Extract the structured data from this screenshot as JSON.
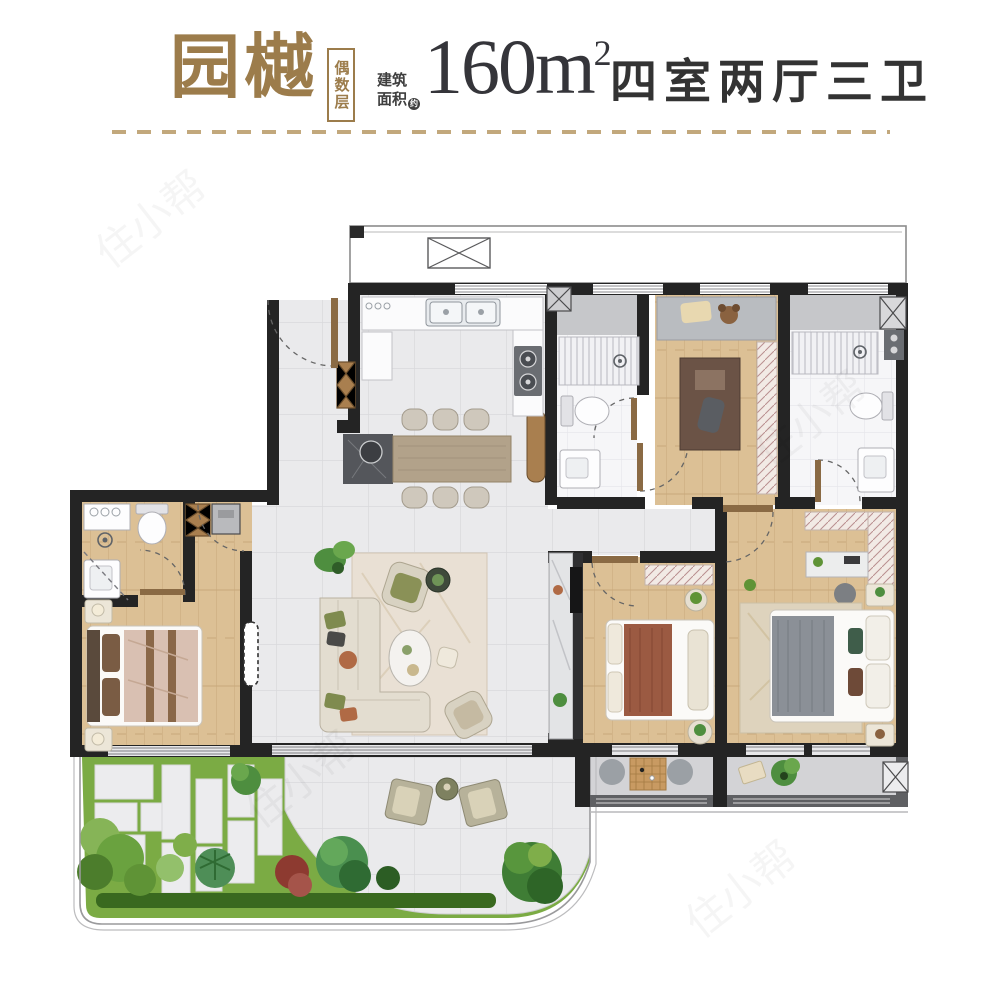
{
  "header": {
    "project_name": "园樾",
    "floor_badge": "偶数层",
    "area_label_line1": "建筑",
    "area_label_line2": "面积",
    "area_note": "约",
    "area_value": "160m",
    "area_sup": "2",
    "layout_title": "四室两厅三卫"
  },
  "watermark": {
    "text": "住小帮"
  },
  "palette": {
    "accent_gold": "#9c7c4b",
    "title_text": "#35353a",
    "wall_dark": "#242424",
    "wall_gray": "#5f6063",
    "wood_floor": "#dcc095",
    "tile_floor": "#eaeaec",
    "bath_floor": "#f6f6f8",
    "marble_band": "#c6c7ca",
    "grass_green": "#7bab44",
    "hedge_green": "#39691f",
    "door_brown": "#8a6a44"
  },
  "plan": {
    "rooms": [
      "entry",
      "kitchen",
      "dining-area",
      "living-room",
      "garden-terrace",
      "bedroom-1-suite",
      "bathroom-1",
      "study-bedroom",
      "bathroom-2",
      "bathroom-3",
      "bedroom-2",
      "master-bedroom",
      "corridor",
      "balcony-1",
      "balcony-2",
      "equipment-balcony"
    ]
  }
}
